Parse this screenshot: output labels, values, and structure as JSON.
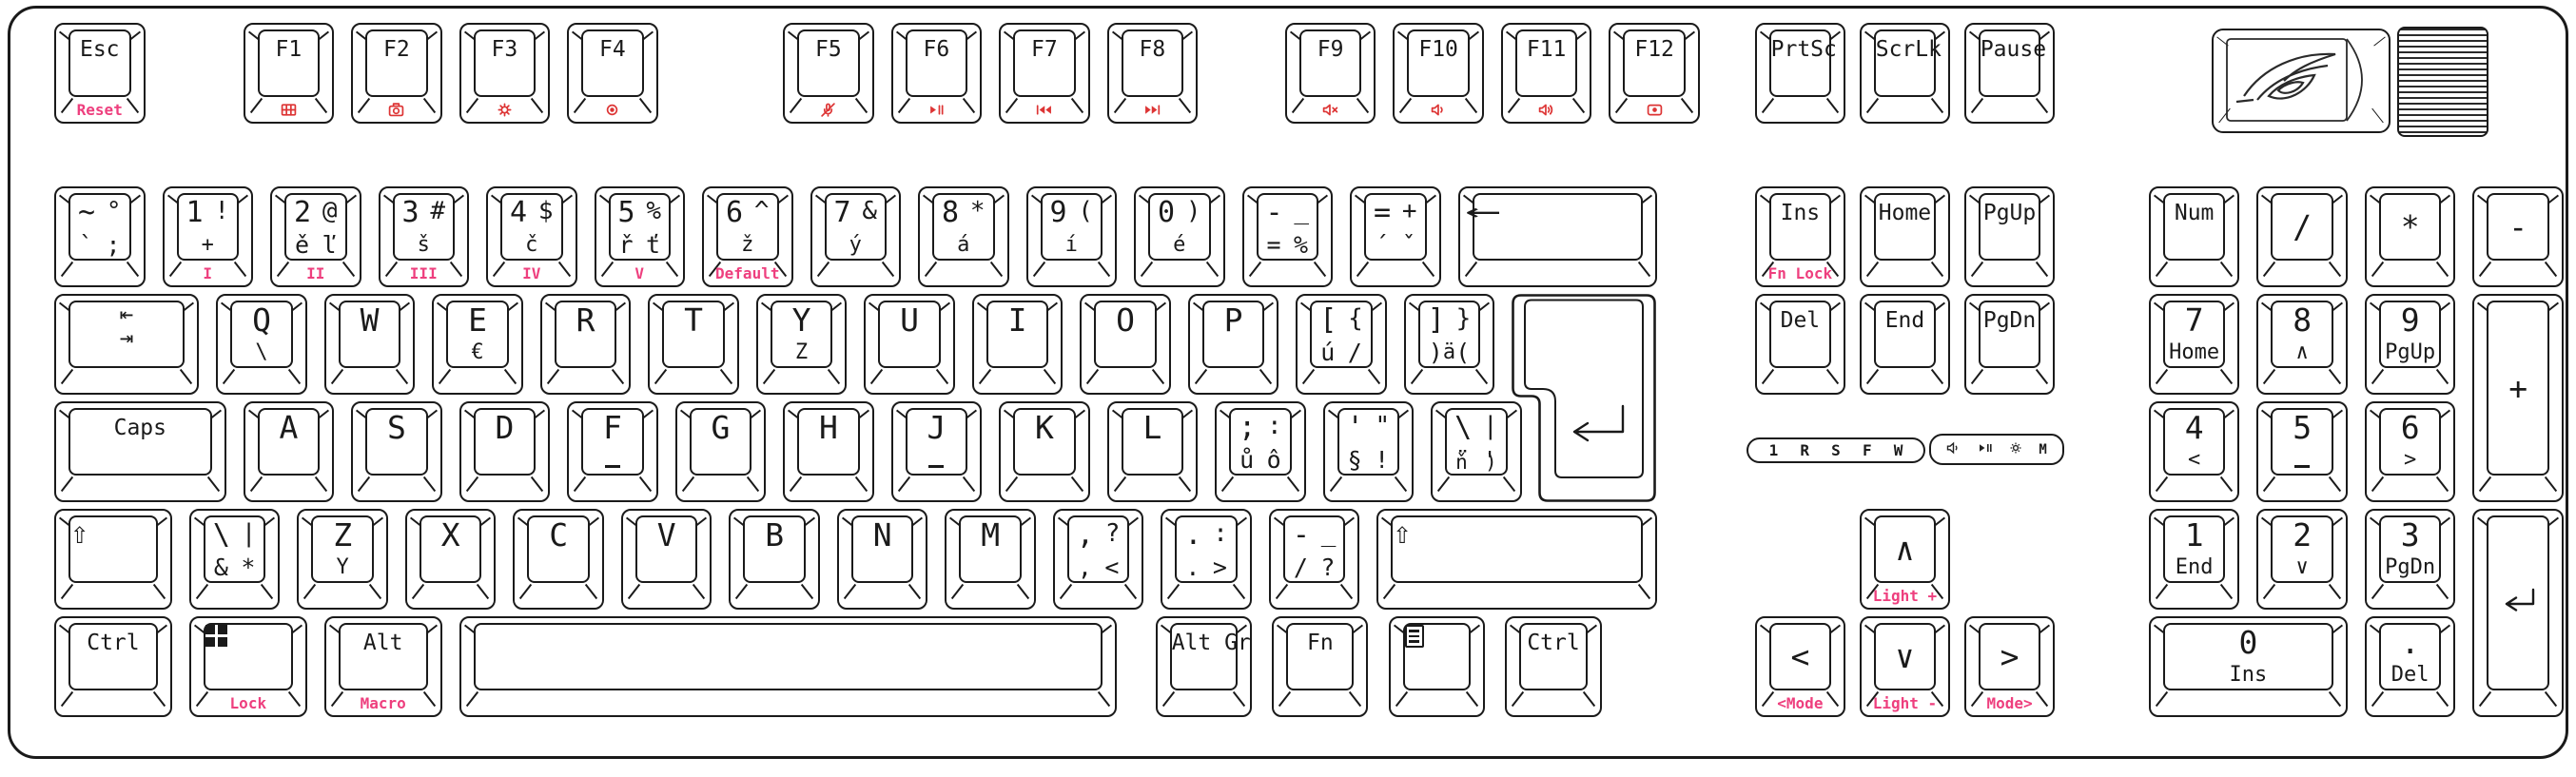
{
  "colors": {
    "outline": "#1a1a1a",
    "front_label": "#ee3f7e",
    "icon_red": "#dd3434"
  },
  "logo": {
    "name": "rog-logo"
  },
  "wheel": {
    "name": "volume-wheel"
  },
  "indicator_panel": {
    "letters": [
      "1",
      "R",
      "S",
      "F",
      "W"
    ],
    "icons": [
      "speaker-icon",
      "play-pause-icon",
      "sun-icon",
      "m-icon"
    ]
  },
  "keyboard": {
    "keys": [
      {
        "n": "key-esc",
        "r": 0,
        "x": 0,
        "w": 1,
        "c": "Esc",
        "f": "Reset"
      },
      {
        "n": "key-f1",
        "r": 0,
        "x": 1.75,
        "c": "F1",
        "fi": "profile-grid-icon"
      },
      {
        "n": "key-f2",
        "r": 0,
        "x": 2.75,
        "c": "F2",
        "fi": "camera-icon"
      },
      {
        "n": "key-f3",
        "r": 0,
        "x": 3.75,
        "c": "F3",
        "fi": "gear-icon"
      },
      {
        "n": "key-f4",
        "r": 0,
        "x": 4.75,
        "c": "F4",
        "fi": "aura-icon"
      },
      {
        "n": "key-f5",
        "r": 0,
        "x": 6.75,
        "c": "F5",
        "fi": "mic-mute-icon"
      },
      {
        "n": "key-f6",
        "r": 0,
        "x": 7.75,
        "c": "F6",
        "fi": "play-pause-icon"
      },
      {
        "n": "key-f7",
        "r": 0,
        "x": 8.75,
        "c": "F7",
        "fi": "prev-track-icon"
      },
      {
        "n": "key-f8",
        "r": 0,
        "x": 9.75,
        "c": "F8",
        "fi": "next-track-icon"
      },
      {
        "n": "key-f9",
        "r": 0,
        "x": 11.4,
        "c": "F9",
        "fi": "volume-mute-icon"
      },
      {
        "n": "key-f10",
        "r": 0,
        "x": 12.4,
        "c": "F10",
        "fi": "volume-down-icon"
      },
      {
        "n": "key-f11",
        "r": 0,
        "x": 13.4,
        "c": "F11",
        "fi": "volume-up-icon"
      },
      {
        "n": "key-f12",
        "r": 0,
        "x": 14.4,
        "c": "F12",
        "fi": "record-icon"
      },
      {
        "n": "key-prtsc",
        "r": 0,
        "x": 15.75,
        "c": "PrtSc"
      },
      {
        "n": "key-scrlk",
        "r": 0,
        "x": 16.72,
        "c": "ScrLk"
      },
      {
        "n": "key-pause",
        "r": 0,
        "x": 17.69,
        "c": "Pause"
      },
      {
        "n": "key-grave",
        "r": 1,
        "x": 0,
        "t": [
          "~",
          "°"
        ],
        "m": [
          "`",
          ";"
        ]
      },
      {
        "n": "key-1",
        "r": 1,
        "x": 1,
        "t": [
          "1",
          "!"
        ],
        "sub": "+",
        "f": "I"
      },
      {
        "n": "key-2",
        "r": 1,
        "x": 2,
        "t": [
          "2",
          "@"
        ],
        "m": [
          "ě",
          "ľ"
        ],
        "f": "II"
      },
      {
        "n": "key-3",
        "r": 1,
        "x": 3,
        "t": [
          "3",
          "#"
        ],
        "sub": "š",
        "f": "III"
      },
      {
        "n": "key-4",
        "r": 1,
        "x": 4,
        "t": [
          "4",
          "$"
        ],
        "sub": "č",
        "f": "IV"
      },
      {
        "n": "key-5",
        "r": 1,
        "x": 5,
        "t": [
          "5",
          "%"
        ],
        "m": [
          "ř",
          "ť"
        ],
        "f": "V"
      },
      {
        "n": "key-6",
        "r": 1,
        "x": 6,
        "t": [
          "6",
          "^"
        ],
        "sub": "ž",
        "f": "Default"
      },
      {
        "n": "key-7",
        "r": 1,
        "x": 7,
        "t": [
          "7",
          "&"
        ],
        "sub": "ý"
      },
      {
        "n": "key-8",
        "r": 1,
        "x": 8,
        "t": [
          "8",
          "*"
        ],
        "sub": "á"
      },
      {
        "n": "key-9",
        "r": 1,
        "x": 9,
        "t": [
          "9",
          "("
        ],
        "sub": "í"
      },
      {
        "n": "key-0",
        "r": 1,
        "x": 10,
        "t": [
          "0",
          ")"
        ],
        "sub": "é"
      },
      {
        "n": "key-minus",
        "r": 1,
        "x": 11,
        "t": [
          "-",
          "_"
        ],
        "m": [
          "=",
          "%"
        ]
      },
      {
        "n": "key-equal",
        "r": 1,
        "x": 12,
        "t": [
          "=",
          "+"
        ],
        "m": [
          "´",
          "ˇ"
        ]
      },
      {
        "n": "key-backspace",
        "r": 1,
        "x": 13,
        "w": 2,
        "ci": "backspace-icon"
      },
      {
        "n": "key-ins",
        "r": 1,
        "x": 15.75,
        "c": "Ins",
        "f": "Fn Lock"
      },
      {
        "n": "key-home",
        "r": 1,
        "x": 16.72,
        "c": "Home"
      },
      {
        "n": "key-pgup",
        "r": 1,
        "x": 17.69,
        "c": "PgUp"
      },
      {
        "n": "key-numlock",
        "r": 1,
        "x": 19.4,
        "c": "Num"
      },
      {
        "n": "key-np-divide",
        "r": 1,
        "x": 20.4,
        "l": "/",
        "cv": true
      },
      {
        "n": "key-np-multiply",
        "r": 1,
        "x": 21.4,
        "l": "*",
        "cv": true
      },
      {
        "n": "key-np-minus",
        "r": 1,
        "x": 22.4,
        "l": "-",
        "cv": true
      },
      {
        "n": "key-tab",
        "r": 2,
        "x": 0,
        "w": 1.5,
        "ci": "tab-icon"
      },
      {
        "n": "key-q",
        "r": 2,
        "x": 1.5,
        "l": "Q",
        "sub": "\\"
      },
      {
        "n": "key-w",
        "r": 2,
        "x": 2.5,
        "l": "W"
      },
      {
        "n": "key-e",
        "r": 2,
        "x": 3.5,
        "l": "E",
        "sub": "€"
      },
      {
        "n": "key-r",
        "r": 2,
        "x": 4.5,
        "l": "R"
      },
      {
        "n": "key-t",
        "r": 2,
        "x": 5.5,
        "l": "T"
      },
      {
        "n": "key-y",
        "r": 2,
        "x": 6.5,
        "l": "Y",
        "sub": "Z"
      },
      {
        "n": "key-u",
        "r": 2,
        "x": 7.5,
        "l": "U"
      },
      {
        "n": "key-i",
        "r": 2,
        "x": 8.5,
        "l": "I"
      },
      {
        "n": "key-o",
        "r": 2,
        "x": 9.5,
        "l": "O"
      },
      {
        "n": "key-p",
        "r": 2,
        "x": 10.5,
        "l": "P"
      },
      {
        "n": "key-lbracket",
        "r": 2,
        "x": 11.5,
        "t": [
          "[",
          "{"
        ],
        "m": [
          "ú",
          "/"
        ]
      },
      {
        "n": "key-rbracket",
        "r": 2,
        "x": 12.5,
        "t": [
          "]",
          "}"
        ],
        "m": [
          ")",
          "("
        ],
        "sub": "ä"
      },
      {
        "n": "key-enter",
        "r": 2,
        "x": 13.5,
        "w": 1.5,
        "h": 2,
        "type": "iso-enter"
      },
      {
        "n": "key-del",
        "r": 2,
        "x": 15.75,
        "c": "Del"
      },
      {
        "n": "key-end",
        "r": 2,
        "x": 16.72,
        "c": "End"
      },
      {
        "n": "key-pgdn",
        "r": 2,
        "x": 17.69,
        "c": "PgDn"
      },
      {
        "n": "key-np-7",
        "r": 2,
        "x": 19.4,
        "l": "7",
        "sub": "Home"
      },
      {
        "n": "key-np-8",
        "r": 2,
        "x": 20.4,
        "l": "8",
        "sub": "∧"
      },
      {
        "n": "key-np-9",
        "r": 2,
        "x": 21.4,
        "l": "9",
        "sub": "PgUp"
      },
      {
        "n": "key-np-plus",
        "r": 2,
        "x": 22.4,
        "h": 2,
        "l": "+",
        "cv": true
      },
      {
        "n": "key-caps",
        "r": 3,
        "x": 0,
        "w": 1.75,
        "c": "Caps"
      },
      {
        "n": "key-a",
        "r": 3,
        "x": 1.75,
        "l": "A"
      },
      {
        "n": "key-s",
        "r": 3,
        "x": 2.75,
        "l": "S"
      },
      {
        "n": "key-d",
        "r": 3,
        "x": 3.75,
        "l": "D"
      },
      {
        "n": "key-f",
        "r": 3,
        "x": 4.75,
        "l": "F",
        "bar": true
      },
      {
        "n": "key-g",
        "r": 3,
        "x": 5.75,
        "l": "G"
      },
      {
        "n": "key-h",
        "r": 3,
        "x": 6.75,
        "l": "H"
      },
      {
        "n": "key-j",
        "r": 3,
        "x": 7.75,
        "l": "J",
        "bar": true
      },
      {
        "n": "key-k",
        "r": 3,
        "x": 8.75,
        "l": "K"
      },
      {
        "n": "key-l",
        "r": 3,
        "x": 9.75,
        "l": "L"
      },
      {
        "n": "key-semicolon",
        "r": 3,
        "x": 10.75,
        "t": [
          ";",
          ":"
        ],
        "m": [
          "ů",
          "ô"
        ]
      },
      {
        "n": "key-quote",
        "r": 3,
        "x": 11.75,
        "t": [
          "'",
          "\""
        ],
        "m": [
          "§",
          "!"
        ]
      },
      {
        "n": "key-hash",
        "r": 3,
        "x": 12.75,
        "t": [
          "\\",
          "|"
        ],
        "m": [
          "¨",
          "'"
        ],
        "b": [
          "ň",
          ")"
        ]
      },
      {
        "n": "key-np-4",
        "r": 3,
        "x": 19.4,
        "l": "4",
        "sub": "<"
      },
      {
        "n": "key-np-5",
        "r": 3,
        "x": 20.4,
        "l": "5",
        "bar": true
      },
      {
        "n": "key-np-6",
        "r": 3,
        "x": 21.4,
        "l": "6",
        "sub": ">"
      },
      {
        "n": "key-lshift",
        "r": 4,
        "x": 0,
        "w": 1.25,
        "ci": "shift-icon"
      },
      {
        "n": "key-iso-backslash",
        "r": 4,
        "x": 1.25,
        "t": [
          "\\",
          "|"
        ],
        "m": [
          "&",
          "*"
        ]
      },
      {
        "n": "key-z",
        "r": 4,
        "x": 2.25,
        "l": "Z",
        "sub": "Y"
      },
      {
        "n": "key-x",
        "r": 4,
        "x": 3.25,
        "l": "X"
      },
      {
        "n": "key-c",
        "r": 4,
        "x": 4.25,
        "l": "C"
      },
      {
        "n": "key-v",
        "r": 4,
        "x": 5.25,
        "l": "V"
      },
      {
        "n": "key-b",
        "r": 4,
        "x": 6.25,
        "l": "B"
      },
      {
        "n": "key-n",
        "r": 4,
        "x": 7.25,
        "l": "N"
      },
      {
        "n": "key-m",
        "r": 4,
        "x": 8.25,
        "l": "M"
      },
      {
        "n": "key-comma",
        "r": 4,
        "x": 9.25,
        "t": [
          ",",
          "?"
        ],
        "m": [
          ",",
          "<"
        ]
      },
      {
        "n": "key-period",
        "r": 4,
        "x": 10.25,
        "t": [
          ".",
          ":"
        ],
        "m": [
          ".",
          ">"
        ]
      },
      {
        "n": "key-slash",
        "r": 4,
        "x": 11.25,
        "t": [
          "-",
          "_"
        ],
        "m": [
          "/",
          "?"
        ]
      },
      {
        "n": "key-rshift",
        "r": 4,
        "x": 12.25,
        "w": 2.75,
        "ci": "shift-icon"
      },
      {
        "n": "key-arrow-up",
        "r": 4,
        "x": 16.72,
        "l": "∧",
        "cv": true,
        "f": "Light +"
      },
      {
        "n": "key-np-1",
        "r": 4,
        "x": 19.4,
        "l": "1",
        "sub": "End"
      },
      {
        "n": "key-np-2",
        "r": 4,
        "x": 20.4,
        "l": "2",
        "sub": "∨"
      },
      {
        "n": "key-np-3",
        "r": 4,
        "x": 21.4,
        "l": "3",
        "sub": "PgDn"
      },
      {
        "n": "key-np-enter",
        "r": 4,
        "x": 22.4,
        "h": 2,
        "ci": "enter-icon",
        "cv": true
      },
      {
        "n": "key-lctrl",
        "r": 5,
        "x": 0,
        "w": 1.25,
        "c": "Ctrl"
      },
      {
        "n": "key-win",
        "r": 5,
        "x": 1.25,
        "w": 1.25,
        "ci": "win-logo-icon",
        "f": "Lock"
      },
      {
        "n": "key-lalt",
        "r": 5,
        "x": 2.5,
        "w": 1.25,
        "c": "Alt",
        "f": "Macro"
      },
      {
        "n": "key-space",
        "r": 5,
        "x": 3.75,
        "w": 6.25,
        "ci": "space-bar"
      },
      {
        "n": "key-altgr",
        "r": 5,
        "x": 10.2,
        "w": 1.05,
        "c": "Alt Gr"
      },
      {
        "n": "key-fn",
        "r": 5,
        "x": 11.28,
        "w": 1.05,
        "c": "Fn"
      },
      {
        "n": "key-menu",
        "r": 5,
        "x": 12.36,
        "w": 1.05,
        "ci": "menu-icon"
      },
      {
        "n": "key-rctrl",
        "r": 5,
        "x": 13.44,
        "w": 1.05,
        "c": "Ctrl"
      },
      {
        "n": "key-arrow-left",
        "r": 5,
        "x": 15.75,
        "l": "<",
        "cv": true,
        "f": "<Mode"
      },
      {
        "n": "key-arrow-down",
        "r": 5,
        "x": 16.72,
        "l": "∨",
        "cv": true,
        "f": "Light -"
      },
      {
        "n": "key-arrow-right",
        "r": 5,
        "x": 17.69,
        "l": ">",
        "cv": true,
        "f": "Mode>"
      },
      {
        "n": "key-np-0",
        "r": 5,
        "x": 19.4,
        "w": 2,
        "l": "0",
        "sub": "Ins"
      },
      {
        "n": "key-np-dot",
        "r": 5,
        "x": 21.4,
        "l": ".",
        "sub": "Del"
      }
    ]
  }
}
